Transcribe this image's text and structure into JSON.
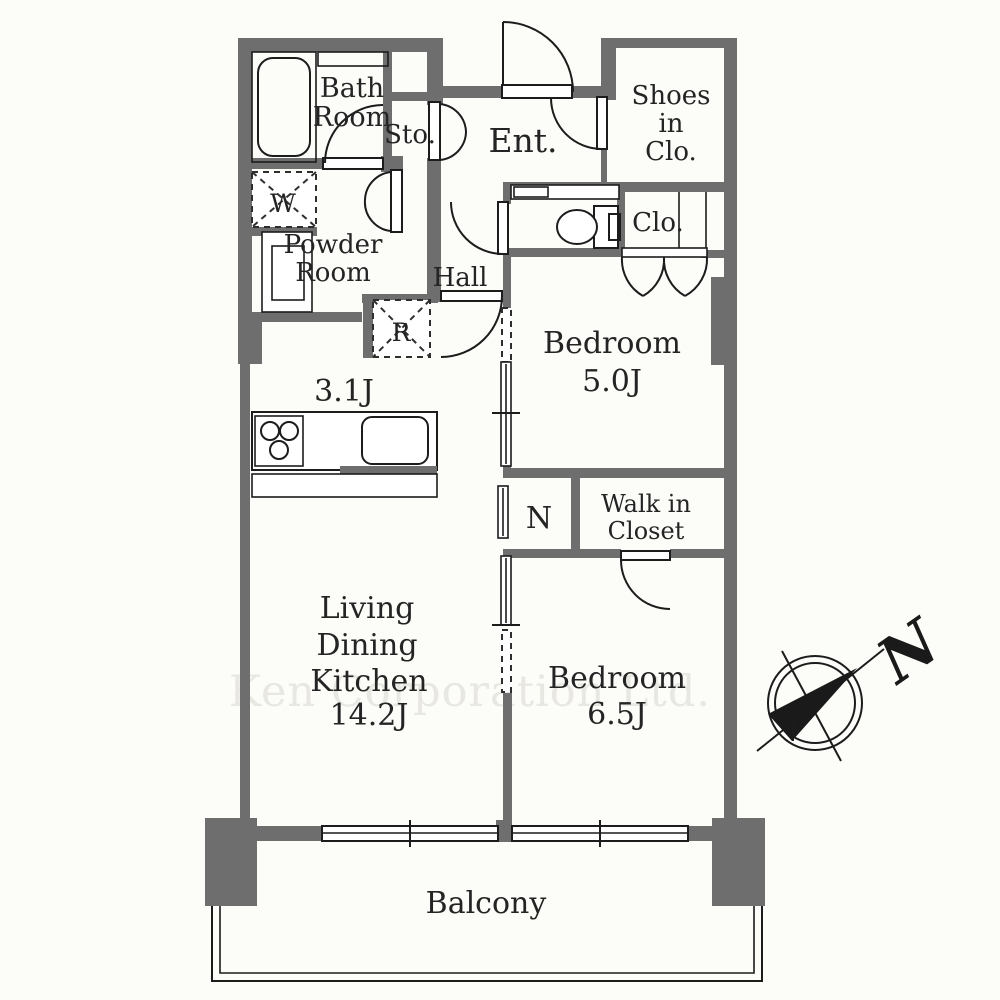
{
  "colors": {
    "wall": "#6e6e6e",
    "line": "#1c1c1c",
    "background": "#fcfcf9",
    "watermark": "#e8e7e2"
  },
  "watermark_text": "Ken Corporation Ltd.",
  "compass": {
    "north": "N"
  },
  "rooms": {
    "bath": {
      "lines": [
        "Bath",
        "Room"
      ]
    },
    "storage": {
      "label": "Sto."
    },
    "entrance": {
      "label": "Ent."
    },
    "shoes_closet": {
      "lines": [
        "Shoes",
        "in",
        "Clo."
      ]
    },
    "closet": {
      "label": "Clo."
    },
    "hall": {
      "label": "Hall"
    },
    "powder": {
      "lines": [
        "Powder",
        "Room"
      ]
    },
    "washer": {
      "label": "W"
    },
    "refrigerator": {
      "label": "R"
    },
    "kitchen_area": {
      "size": "3.1J"
    },
    "bedroom1": {
      "lines": [
        "Bedroom",
        "5.0J"
      ]
    },
    "niche": {
      "label": "N"
    },
    "walk_in_closet": {
      "lines": [
        "Walk in",
        "Closet"
      ]
    },
    "ldk": {
      "lines": [
        "Living",
        "Dining",
        "Kitchen",
        "14.2J"
      ]
    },
    "bedroom2": {
      "lines": [
        "Bedroom",
        "6.5J"
      ]
    },
    "balcony": {
      "label": "Balcony"
    }
  }
}
